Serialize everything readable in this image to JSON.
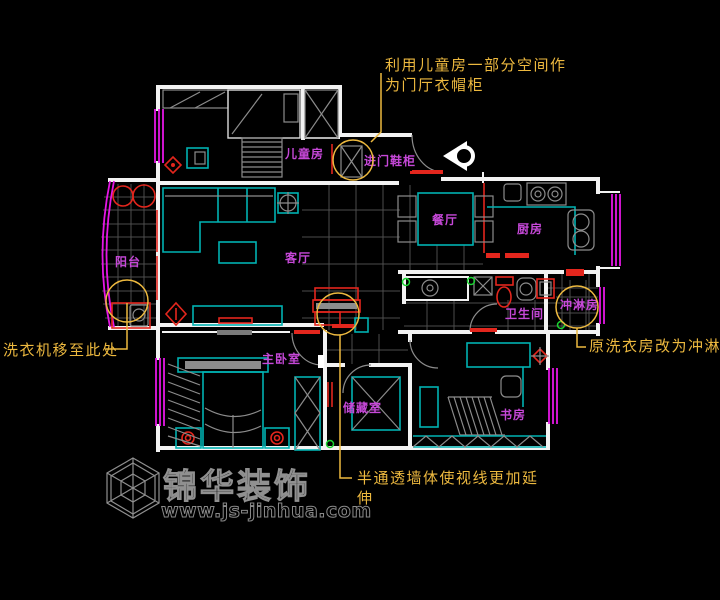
{
  "plan": {
    "rooms": {
      "children_room": "儿童房",
      "entry_cabinet": "进门鞋柜",
      "dining": "餐厅",
      "kitchen": "厨房",
      "living": "客厅",
      "balcony": "阳台",
      "master_bedroom": "主卧室",
      "storage": "储藏室",
      "study": "书房",
      "bathroom": "卫生间",
      "shower": "冲淋房"
    },
    "annotations": {
      "top_line1": "利用儿童房一部分空间作",
      "top_line2": "为门厅衣帽柜",
      "right": "原洗衣房改为冲淋房",
      "bottom_left": "洗衣机移至此处",
      "bottom_center_line1": "半通透墙体使视线更加延",
      "bottom_center_line2": "伸"
    },
    "colors": {
      "wall": "#f2f2f2",
      "furniture": "#00b2b2",
      "accent_red": "#e3261d",
      "window": "#e516e5",
      "room_label": "#c648d8",
      "annotation": "#edb93f",
      "marker_green": "#19d430",
      "detail_gray": "#8c8c8c"
    }
  },
  "watermark": {
    "brand": "锦华装饰",
    "url": "www.js-jinhua.com"
  }
}
